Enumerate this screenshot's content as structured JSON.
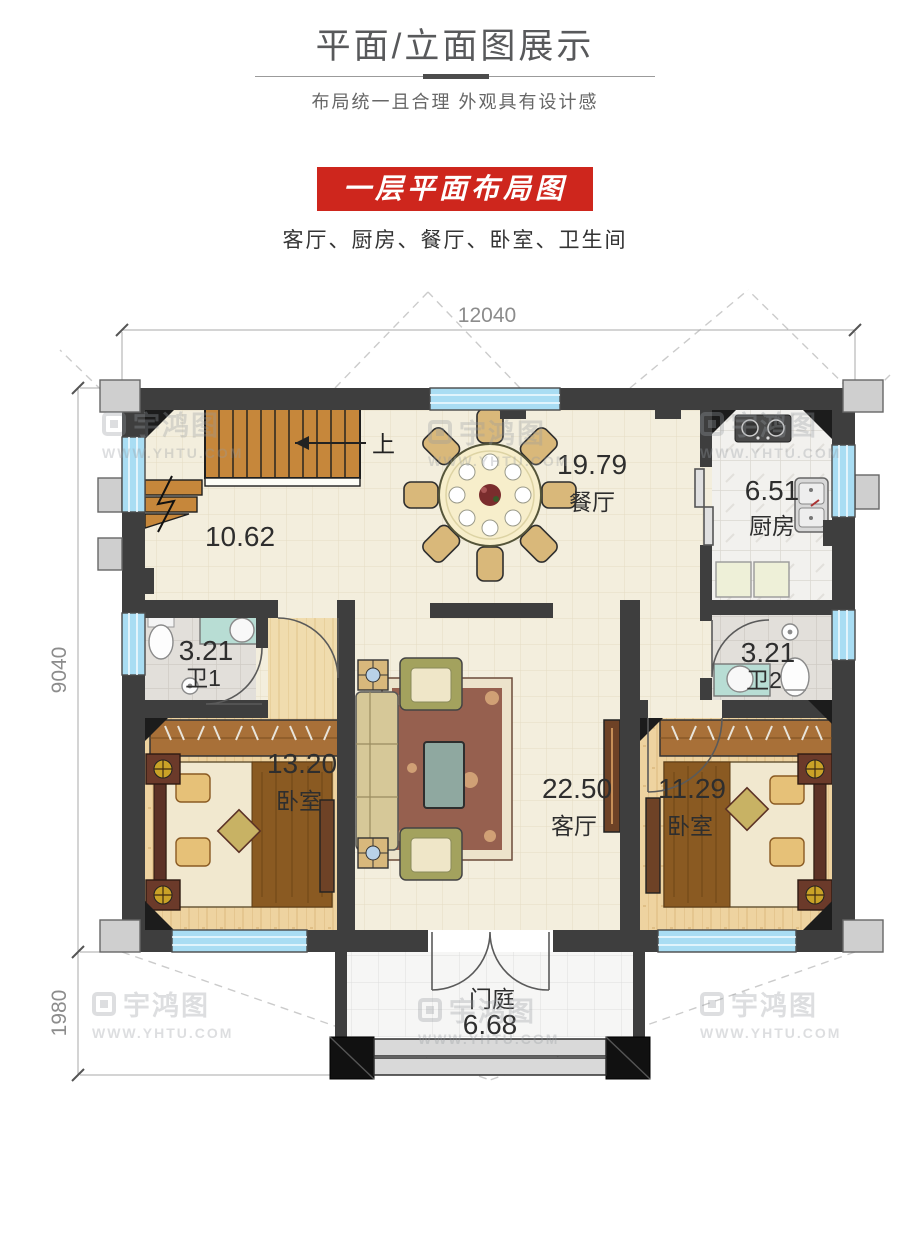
{
  "header": {
    "title": "平面/立面图展示",
    "subtitle": "布局统一且合理 外观具有设计感"
  },
  "section": {
    "banner": "一层平面布局图",
    "room_list": "客厅、厨房、餐厅、卧室、卫生间"
  },
  "dimensions": {
    "top_width": "12040",
    "left_height": "9040",
    "porch_height": "1980"
  },
  "rooms": {
    "stair_hall": {
      "area": "10.62"
    },
    "dining": {
      "name": "餐厅",
      "area": "19.79"
    },
    "kitchen": {
      "name": "厨房",
      "area": "6.51"
    },
    "bath1": {
      "name": "卫1",
      "area": "3.21"
    },
    "bath2": {
      "name": "卫2",
      "area": "3.21"
    },
    "bedroom_left": {
      "name": "卧室",
      "area": "13.20"
    },
    "living": {
      "name": "客厅",
      "area": "22.50"
    },
    "bedroom_right": {
      "name": "卧室",
      "area": "11.29"
    },
    "porch": {
      "name": "门庭",
      "area": "6.68"
    }
  },
  "stair": {
    "up_label": "上"
  },
  "watermark": {
    "brand": "宇鸿图",
    "url": "WWW.YHTU.COM"
  },
  "colors": {
    "banner_red": "#ce261d",
    "wall": "#3e3e3e",
    "window_blue": "#a9ddf3",
    "floor_cream": "#f3eedd",
    "floor_wood": "#eed3a0",
    "stair_wood": "#c6873b"
  }
}
